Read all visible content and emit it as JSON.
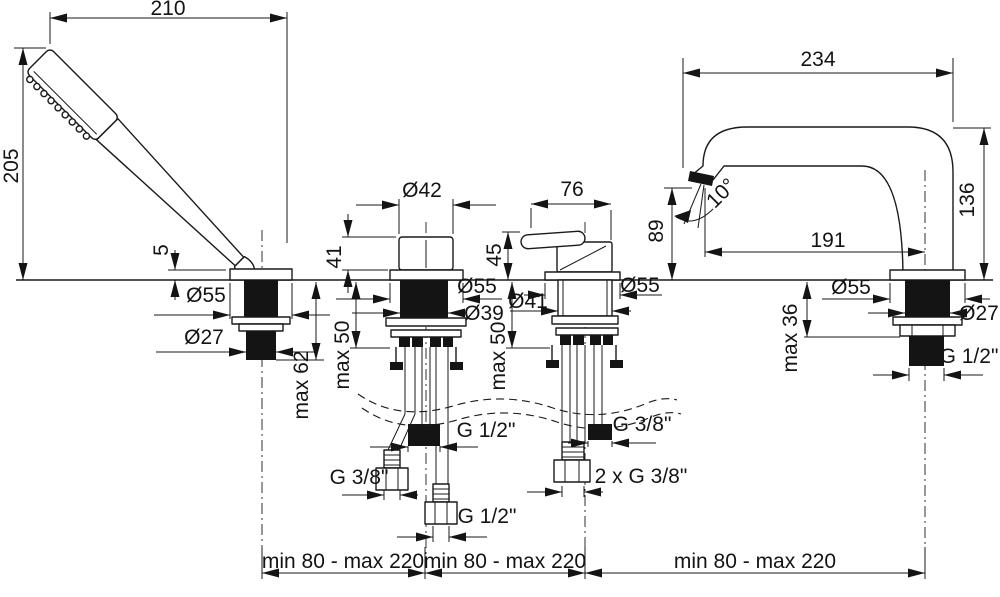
{
  "drawing": {
    "hand_shower": {
      "width": "210",
      "height": "205",
      "escutcheon_height": "5",
      "escutcheon_dia": "Ø55",
      "shank_dia": "Ø27",
      "max_deck": "max 62"
    },
    "diverter_valve": {
      "knob_dia": "Ø42",
      "height": "41",
      "flange_dia": "Ø55",
      "body_dia": "Ø39",
      "max_deck": "max 50",
      "outlet_thread": "G 1/2\"",
      "hose_thread": "G 3/8\"",
      "shower_hose_thread": "G 1/2\""
    },
    "mixer_valve": {
      "width": "76",
      "height": "45",
      "body_dia": "Ø41",
      "flange_dia": "Ø55",
      "max_deck": "max 50",
      "outlet_thread": "G 3/8\"",
      "hose_thread": "2 x G 3/8\""
    },
    "spout": {
      "reach": "234",
      "height": "136",
      "outlet_height": "89",
      "spray_angle": "10°",
      "axis_reach": "191",
      "flange_dia": "Ø55",
      "shank_dia": "Ø27",
      "max_deck": "max 36",
      "thread": "G 1/2\""
    },
    "spacing": {
      "left": "min 80 - max 220",
      "middle": "min 80 - max 220",
      "right": "min 80 - max 220"
    }
  }
}
